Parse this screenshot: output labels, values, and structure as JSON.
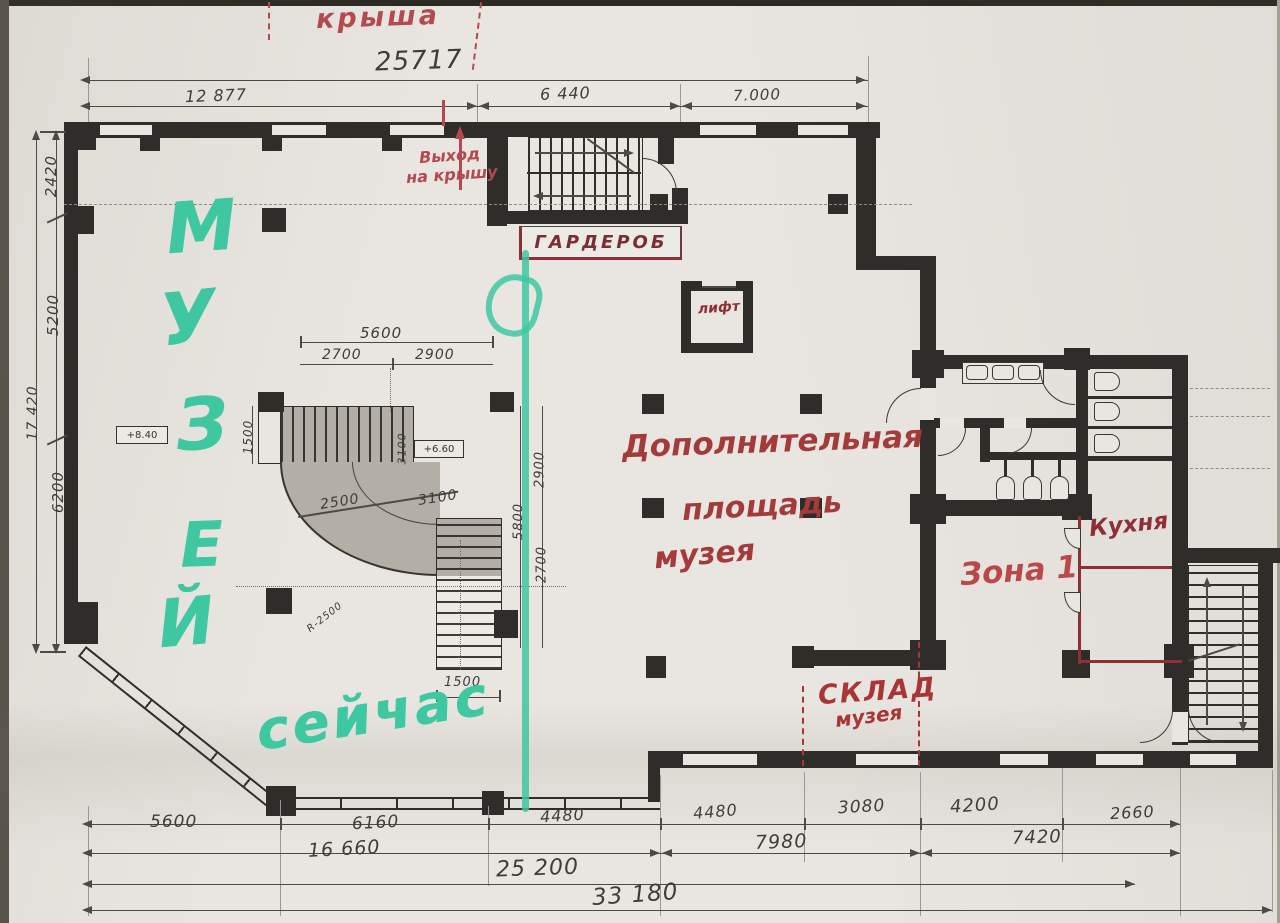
{
  "green": {
    "letters": [
      "М",
      "У",
      "З",
      "Е",
      "Й"
    ],
    "now": "сейчас",
    "color": "#3fc7a2"
  },
  "red": {
    "roof": "крыша",
    "exit1": "Выход",
    "exit2": "на крышу",
    "wardrobe": "ГАРДЕРОБ",
    "lift": "лифт",
    "add1": "Дополнительная",
    "add2": "площадь",
    "add3": "музея",
    "zone": "Зона 1",
    "kitchen": "Кухня",
    "store1": "СКЛАД",
    "store2": "музея",
    "color_bright": "#b4494f",
    "color_dark": "#8e2f38"
  },
  "levels": {
    "hall": "+8.40",
    "stair": "+6.60"
  },
  "dims": {
    "top_total": "25717",
    "top_1": "12 877",
    "top_2": "6 440",
    "top_3": "7.000",
    "left_1": "2420",
    "left_2": "5200",
    "left_3": "6200",
    "left_total": "17 420",
    "stair_total": "5600",
    "stair_1": "2700",
    "stair_2": "2900",
    "stair_left": "1500",
    "stair_bottom": "1500",
    "stair_diag1": "2500",
    "stair_diag2": "3100",
    "stair_mid": "3100",
    "stair_radius": "R-2500",
    "right_1": "2900",
    "right_2": "5800",
    "right_3": "2700",
    "bottom_a1": "5600",
    "bottom_a2": "6160",
    "bottom_a3": "4480",
    "bottom_a4": "4480",
    "bottom_a5": "3080",
    "bottom_a6": "4200",
    "bottom_a7": "2660",
    "bottom_b1": "16 660",
    "bottom_b2": "7980",
    "bottom_b3": "7420",
    "bottom_c": "25 200",
    "bottom_d": "33 180",
    "pencil_color": "#4b4a47"
  }
}
